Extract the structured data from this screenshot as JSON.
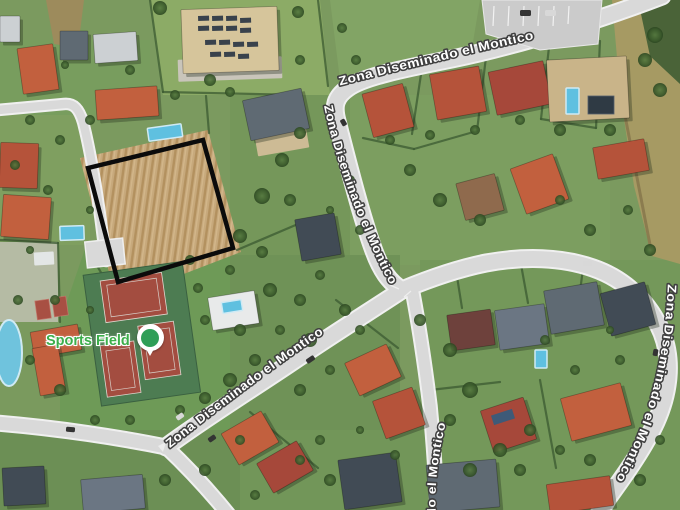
{
  "map": {
    "road_labels": [
      {
        "id": "top",
        "text": "Zona Diseminado el Montico"
      },
      {
        "id": "northwest",
        "text": "Zona Diseminado el Montico"
      },
      {
        "id": "southwest",
        "text": "Zona Diseminado el Montico"
      },
      {
        "id": "east",
        "text": "Zona Diseminado el Montico"
      },
      {
        "id": "south",
        "text": "do el Montico"
      }
    ],
    "poi": {
      "label": "Sports Field",
      "icon": "sports-field-pin"
    },
    "colors": {
      "road_label_fill": "#ffffff",
      "road_label_halo": "#404040",
      "poi_text_green": "#3cae4a",
      "pin_green": "#2f9e57",
      "plot_outline": "#0b0b0b",
      "road_fill": "#d9d9d9",
      "road_casing": "#f0f0f0",
      "field_tan": "#c7a97c"
    }
  }
}
